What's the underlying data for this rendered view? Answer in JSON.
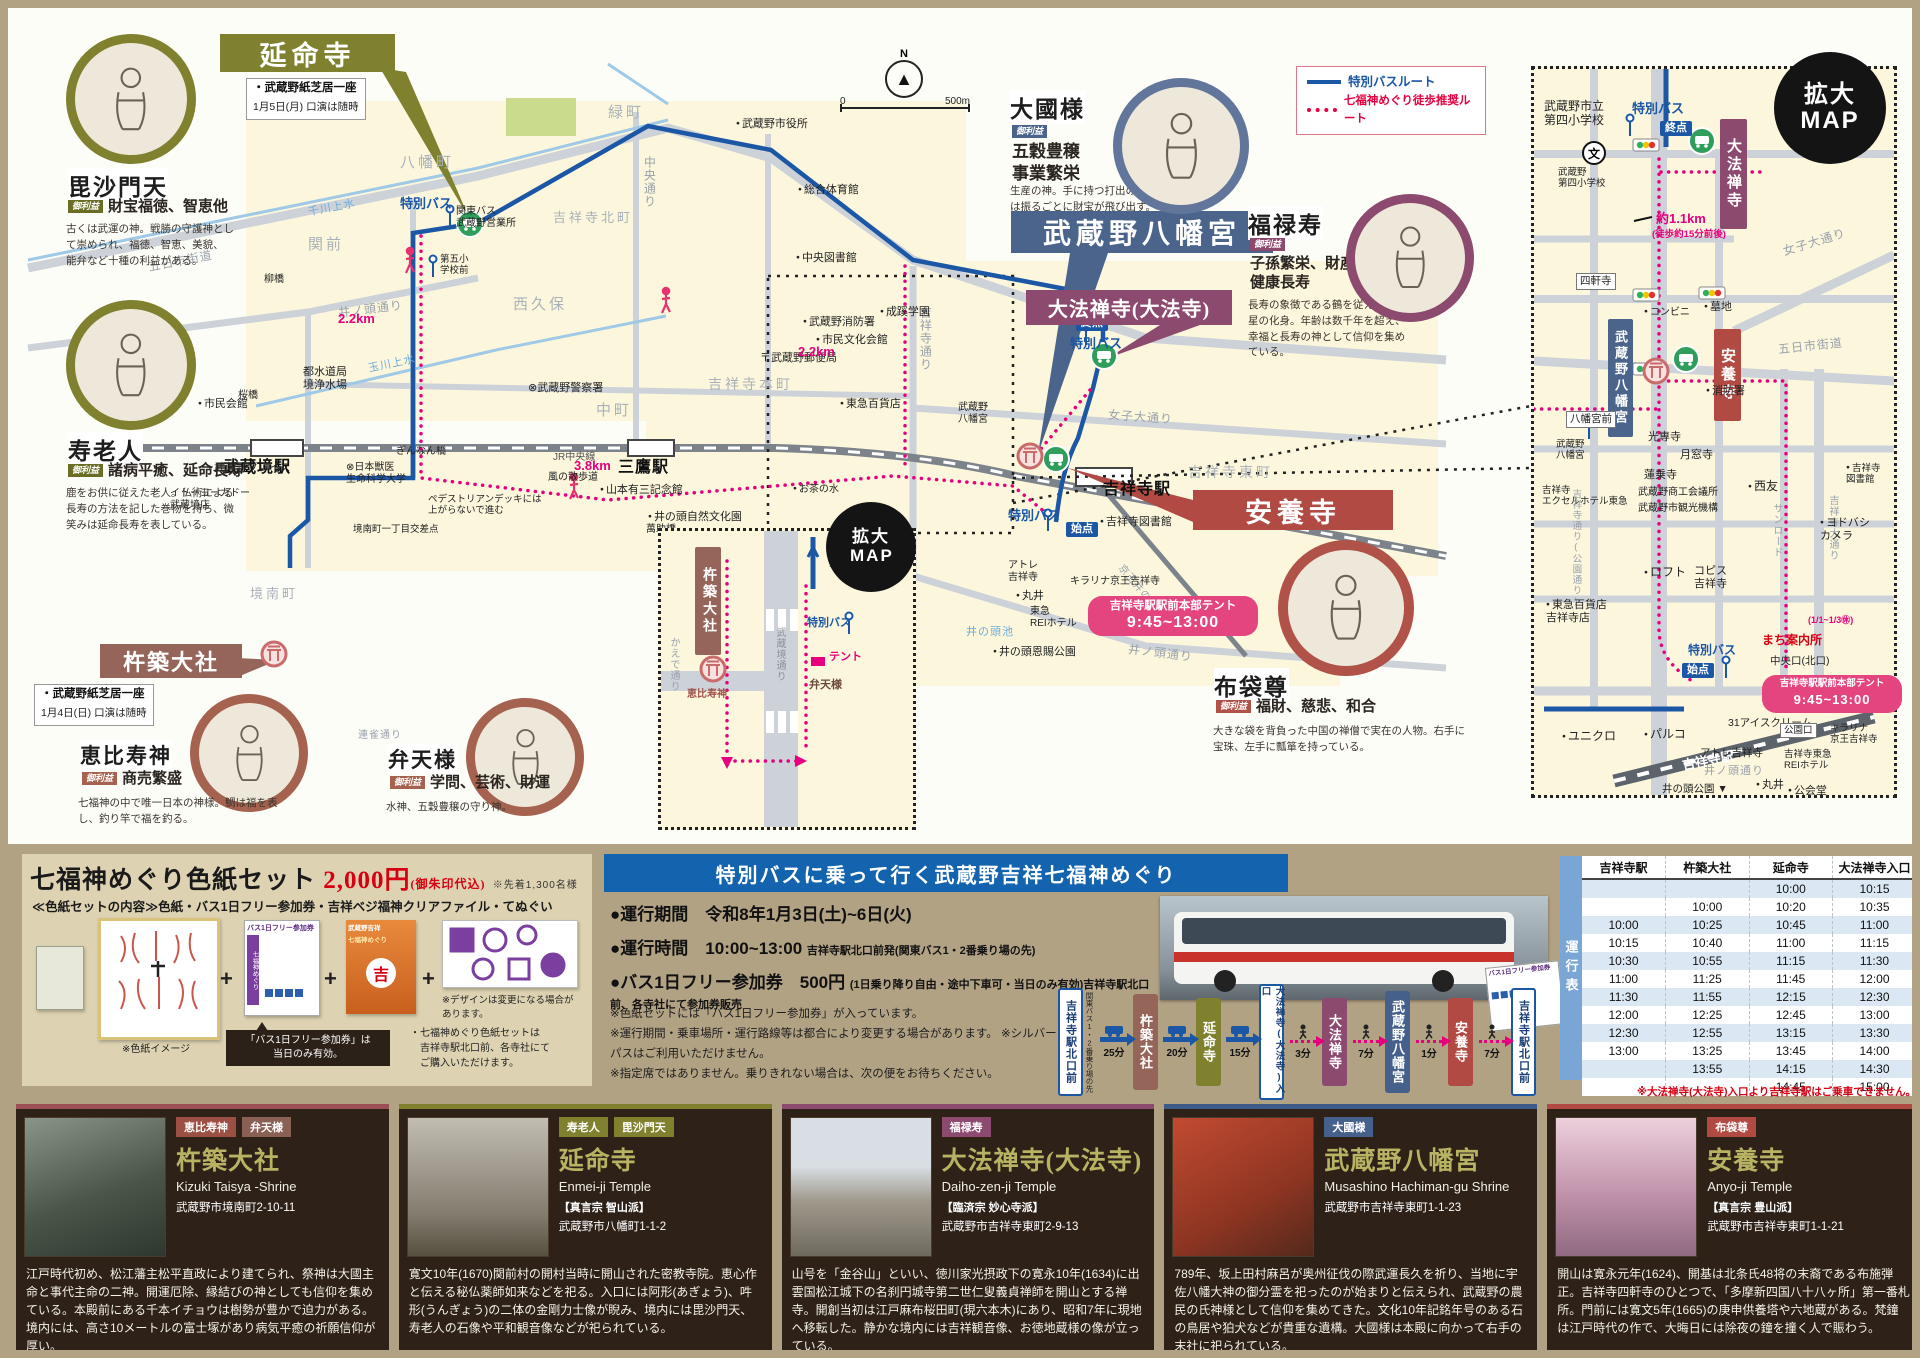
{
  "legend": {
    "bus": "特別バスルート",
    "walk": "七福神めぐり徒歩推奨ルート"
  },
  "compass": {
    "n": "N"
  },
  "scalebar": {
    "zero": "0",
    "end": "500m"
  },
  "enlarged_title": "拡大MAP",
  "tent": {
    "line1": "吉祥寺駅駅前本部テント",
    "line2": "9:45~13:00"
  },
  "banners": {
    "enmeiji": {
      "label": "延命寺",
      "note_title": "・武蔵野紙芝居一座",
      "note_sub": "1月5日(月) 口演は随時"
    },
    "hachimangu": {
      "label": "武蔵野八幡宮"
    },
    "daiho": {
      "label": "大法禅寺(大法寺)"
    },
    "anyo": {
      "label": "安養寺"
    },
    "kizuki": {
      "label": "杵築大社",
      "note_title": "・武蔵野紙芝居一座",
      "note_sub": "1月4日(日) 口演は随時"
    }
  },
  "deities": {
    "bishamonten": {
      "name": "毘沙門天",
      "badge": "御利益",
      "benefit": "財宝福徳、智恵他",
      "desc": "古くは武運の神。戦勝の守護神として崇められ、福徳、智恵、美貌、能弁など十種の利益がある。"
    },
    "jurojin": {
      "name": "寿老人",
      "badge": "御利益",
      "benefit": "諸病平癒、延命長寿",
      "desc": "鹿をお供に従えた老人。仏術による長寿の方法を記した巻物を持ち、微笑みは延命長寿を表している。"
    },
    "daikoku": {
      "name": "大國様",
      "badge": "御利益",
      "benefit": "五穀豊穣\n事業繁栄",
      "desc": "生産の神。手に持つ打出の小槌は振るごとに財宝が飛び出す。"
    },
    "fukuroku": {
      "name": "福禄寿",
      "badge": "御利益",
      "benefit": "子孫繁栄、財産\n健康長寿",
      "desc": "長寿の象徴である鶴を従えた南極星の化身。年齢は数千年を超え、幸福と長寿の神として信仰を集めている。"
    },
    "hotei": {
      "name": "布袋尊",
      "badge": "御利益",
      "benefit": "福財、慈悲、和合",
      "desc": "大きな袋を背負った中国の禅僧で実在の人物。右手に宝珠、左手に瓢箪を持っている。"
    },
    "ebisu": {
      "name": "恵比寿神",
      "badge": "御利益",
      "benefit": "商売繁盛",
      "desc": "七福神の中で唯一日本の神様。鯛は福を表し、釣り竿で福を釣る。"
    },
    "benten": {
      "name": "弁天様",
      "badge": "御利益",
      "benefit": "学問、芸術、財運",
      "desc": "水神、五穀豊穣の守り神。"
    }
  },
  "map_labels": [
    "八幡町",
    "緑町",
    "関前",
    "西久保",
    "吉祥寺北町",
    "中町",
    "吉祥寺本町",
    "吉祥寺東町",
    "境",
    "境南町",
    "五日市街道",
    "井ノ頭通り",
    "千川上水",
    "玉川上水",
    "女子大通り",
    "中央通り",
    "吉祥寺通り",
    "井ノ頭通り",
    "連雀通り",
    "JR中央線",
    "京王井の頭線",
    "武蔵境駅",
    "三鷹駅",
    "吉祥寺駅",
    "総合体育館",
    "武蔵野市役所",
    "中央図書館",
    "武蔵野消防署",
    "成蹊学園",
    "市民文化会館",
    "〒武蔵野郵便局",
    "都水道局\n境浄水場",
    "市民会館",
    "⊗武蔵野警察署",
    "関東バス\n武蔵野営業所",
    "武蔵野プレイス",
    "イトーヨーカドー\n武蔵境店",
    "⊗日本獣医\n生命科学大学",
    "山本有三記念館",
    "井の頭自然文化園",
    "井の頭恩賜公園",
    "井の頭池",
    "お茶の水",
    "風の散歩道",
    "萬助橋",
    "東急百貨店",
    "吉祥寺図書館",
    "アトレ\n吉祥寺",
    "東急\nREIホテル",
    "丸井",
    "キラリナ京王吉祥寺",
    "武蔵野\n八幡宮",
    "ぎんなん橋",
    "桜橋",
    "柳橋",
    "第五小\n学校前",
    "特別バス",
    "特別バス",
    "特別バス",
    "始点",
    "終点",
    "2.2km",
    "2.2km",
    "3.8km",
    "ペデストリアンデッキには\n上がらないで進む",
    "境南町一丁目交差点"
  ],
  "enlarged": {
    "labels": [
      "武蔵野市立\n第四小学校",
      "武蔵野\n第四小学校",
      "特別バス",
      "終点",
      "大法禅寺",
      "約1.1km",
      "(徒歩約15分前後)",
      "四軒寺",
      "女子大通り",
      "コンビニ",
      "墓地",
      "武蔵野八幡宮",
      "安養寺",
      "消防署",
      "八幡宮前",
      "武蔵野\n八幡宮",
      "五日市街道",
      "吉祥寺\nエクセルホテル東急",
      "光専寺",
      "月窓寺",
      "蓮乗寺",
      "武蔵野商工会議所",
      "武蔵野市観光機構",
      "西友",
      "サンロード",
      "吉祥寺大通り",
      "吉祥寺通り(公園通り)",
      "ヨドバシ\nカメラ",
      "吉祥寺\n図書館",
      "ロフト",
      "コピス\n吉祥寺",
      "東急百貨店\n吉祥寺店",
      "まち案内所",
      "(1/1~1/3㊡)",
      "中央口(北口)",
      "特別バス",
      "始点",
      "ユニクロ",
      "パルコ",
      "吉祥寺駅",
      "31アイスクリーム",
      "公園口",
      "キラリナ\n京王吉祥寺",
      "アトレ吉祥寺",
      "井ノ頭通り",
      "吉祥寺東急\nREIホテル",
      "丸井",
      "公会堂",
      "井の頭公園 ▼",
      "文"
    ]
  },
  "inset": {
    "labels": [
      "杵築大社",
      "恵比寿神",
      "かえで通り",
      "武蔵境通り",
      "特別バス",
      "テント",
      "弁天様",
      "⊗日本獣医\n生命科学\n大学"
    ]
  },
  "shikishi": {
    "title": "七福神めぐり色紙セット",
    "price": "2,000円",
    "price_note": "(御朱印代込)",
    "limit": "※先着1,300名様",
    "contents": "≪色紙セットの内容≫色紙・バス1日フリー参加券・吉祥ベジ福神クリアファイル・てぬぐい",
    "callout": "「バス1日フリー参加券」は\n当日のみ有効。",
    "img_caption": "※色紙イメージ",
    "design_note": "※デザインは変更になる場合が\nあります。",
    "purchase_note": "・七福神めぐり色紙セットは\n　吉祥寺駅北口前、各寺社にて\n　ご購入いただけます。",
    "ticket_title": "バス1日フリー参加券",
    "ticket_side": "七福神めぐり",
    "file_line1": "武蔵野吉祥",
    "file_line2": "七福神めぐり",
    "file_mark": "吉",
    "plus": "+"
  },
  "bus_panel": {
    "title": "特別バスに乗って行く武蔵野吉祥七福神めぐり",
    "b1_label": "●運行期間",
    "b1_value": "令和8年1月3日(土)~6日(火)",
    "b2_label": "●運行時間",
    "b2_value": "10:00~13:00",
    "b2_sub": "吉祥寺駅北口前発(関東バス1・2番乗り場の先)",
    "b3_label": "●バス1日フリー参加券",
    "b3_value": "500円",
    "b3_sub": "(1日乗り降り自由・途中下車可・当日のみ有効)吉祥寺駅北口前、各寺社にて参加券販売",
    "notes": [
      "※色紙セットには「バス1日フリー参加券」が入っています。",
      "※運行期間・乗車場所・運行路線等は都合により変更する場合があります。 ※シルバーパスはご利用いただけません。",
      "※指定席ではありません。乗りきれない場合は、次の便をお待ちください。"
    ]
  },
  "route": {
    "stops": [
      {
        "label": "吉祥寺駅北口前",
        "sub": "関東バス1・2番乗り場の先"
      },
      {
        "label": "杵築大社"
      },
      {
        "label": "延命寺"
      },
      {
        "label": "大法禅寺(大法寺)入口"
      },
      {
        "label": "大法禅寺"
      },
      {
        "label": "武蔵野八幡宮"
      },
      {
        "label": "安養寺"
      },
      {
        "label": "吉祥寺駅北口前"
      }
    ],
    "times": [
      "25分",
      "20分",
      "15分",
      "3分",
      "7分",
      "1分",
      "7分"
    ]
  },
  "timetable": {
    "tab": "運行表",
    "headers": [
      "吉祥寺駅",
      "杵築大社",
      "延命寺",
      "大法禅寺入口"
    ],
    "rows": [
      [
        "",
        "",
        "10:00",
        "10:15"
      ],
      [
        "",
        "10:00",
        "10:20",
        "10:35"
      ],
      [
        "10:00",
        "10:25",
        "10:45",
        "11:00"
      ],
      [
        "10:15",
        "10:40",
        "11:00",
        "11:15"
      ],
      [
        "10:30",
        "10:55",
        "11:15",
        "11:30"
      ],
      [
        "11:00",
        "11:25",
        "11:45",
        "12:00"
      ],
      [
        "11:30",
        "11:55",
        "12:15",
        "12:30"
      ],
      [
        "12:00",
        "12:25",
        "12:45",
        "13:00"
      ],
      [
        "12:30",
        "12:55",
        "13:15",
        "13:30"
      ],
      [
        "13:00",
        "13:25",
        "13:45",
        "14:00"
      ],
      [
        "",
        "13:55",
        "14:15",
        "14:30"
      ],
      [
        "",
        "",
        "14:45",
        "15:00"
      ]
    ],
    "footnote": "※大法禅寺(大法寺)入口より吉祥寺駅はご乗車できません。"
  },
  "cards": [
    {
      "name": "杵築大社",
      "romaji": "Kizuki Taisya -Shrine",
      "sect": "",
      "addr": "武蔵野市境南町2-10-11",
      "strip": "#9c4f55",
      "photo": "p1",
      "badges": [
        {
          "t": "恵比寿神",
          "c": "#9c4f43"
        },
        {
          "t": "弁天様",
          "c": "#8a6055"
        }
      ],
      "desc": "江戸時代初め、松江藩主松平直政により建てられ、祭神は大國主命と事代主命の二神。開運厄除、縁結びの神としても信仰を集めている。本殿前にある千本イチョウは樹勢が豊かで迫力がある。境内には、高さ10メートルの富士塚があり病気平癒の祈願信仰が厚い。"
    },
    {
      "name": "延命寺",
      "romaji": "Enmei-ji Temple",
      "sect": "【真言宗 智山派】",
      "addr": "武蔵野市八幡町1-1-2",
      "strip": "#7f812f",
      "photo": "p2",
      "badges": [
        {
          "t": "寿老人",
          "c": "#7f812f"
        },
        {
          "t": "毘沙門天",
          "c": "#7f812f"
        }
      ],
      "desc": "寛文10年(1670)関前村の開村当時に開山された密教寺院。恵心作と伝える秘仏薬師如来などを祀る。入口には阿形(あぎょう)、吽形(うんぎょう)の二体の金剛力士像が睨み、境内には毘沙門天、寿老人の石像や平和観音像などが祀られている。"
    },
    {
      "name": "大法禅寺(大法寺)",
      "romaji": "Daiho-zen-ji Temple",
      "sect": "【臨済宗 妙心寺派】",
      "addr": "武蔵野市吉祥寺東町2-9-13",
      "strip": "#8c4a6e",
      "photo": "p3",
      "badges": [
        {
          "t": "福禄寿",
          "c": "#8c4a6e"
        }
      ],
      "desc": "山号を「金谷山」といい、徳川家光摂政下の寛永10年(1634)に出雲国松江城下の名刹円城寺第二世仁叟義貞禅師を開山とする禅寺。開創当初は江戸麻布桜田町(現六本木)にあり、昭和7年に現地へ移転した。静かな境内には吉祥観音像、お徳地蔵様の像が立っている。"
    },
    {
      "name": "武蔵野八幡宮",
      "romaji": "Musashino Hachiman-gu Shrine",
      "sect": "",
      "addr": "武蔵野市吉祥寺東町1-1-23",
      "strip": "#3d5a88",
      "photo": "p4",
      "badges": [
        {
          "t": "大國様",
          "c": "#46608c"
        }
      ],
      "desc": "789年、坂上田村麻呂が奥州征伐の際武運長久を祈り、当地に宇佐八幡大神の御分霊を祀ったのが始まりと伝えられ、武蔵野の農民の氏神様として信仰を集めてきた。文化10年記銘年号のある石の鳥居や狛犬などが貴重な遺構。大國様は本殿に向かって右手の末社に祀られている。"
    },
    {
      "name": "安養寺",
      "romaji": "Anyo-ji Temple",
      "sect": "【真言宗 豊山派】",
      "addr": "武蔵野市吉祥寺東町1-1-21",
      "strip": "#b04a42",
      "photo": "p5",
      "badges": [
        {
          "t": "布袋尊",
          "c": "#b04a42"
        }
      ],
      "desc": "開山は寛永元年(1624)、開基は北条氏48将の末裔である布施弾正。吉祥寺四軒寺のひとつで、「多摩新四国八十八ヶ所」第一番札所。門前には寛文5年(1665)の庚申供養塔や六地蔵がある。梵鐘は江戸時代の作で、大晦日には除夜の鐘を撞く人で賑わう。"
    }
  ]
}
